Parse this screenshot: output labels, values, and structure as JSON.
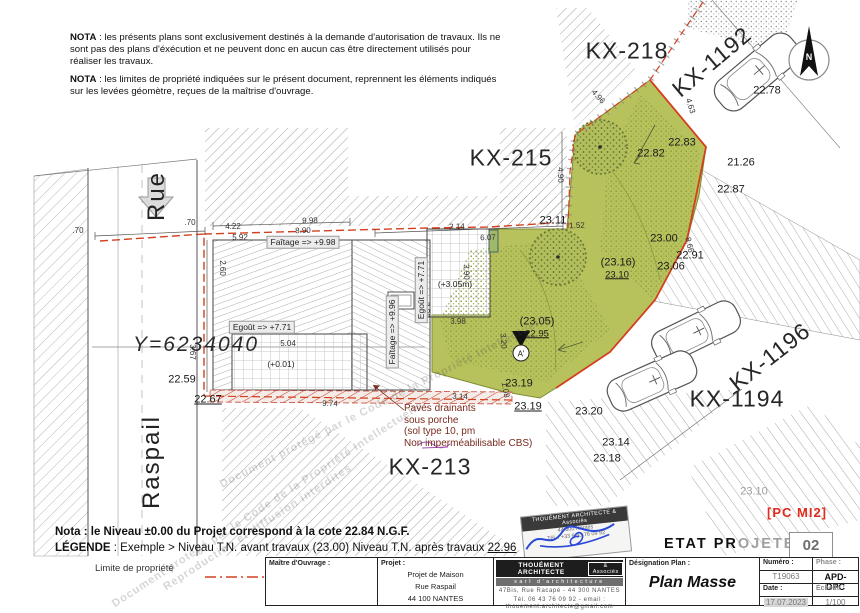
{
  "notes": {
    "nota1_label": "NOTA",
    "nota1_text": " : les présents plans sont exclusivement destinés à la demande d'autorisation de travaux. Ils ne sont pas des plans d'éxécution et ne peuvent donc en aucun cas être directement utilisés pour réaliser les travaux.",
    "nota2_label": "NOTA",
    "nota2_text": " : les limites de propriété indiquées sur le présent document, reprennent les éléments indiqués sur les levées géomètre, reçues de la maîtrise d'ouvrage.",
    "nota_niveau": "Nota : le Niveau ±0.00 du Projet correspond à la cote 22.84 N.G.F.",
    "legende_label": "LÉGENDE",
    "legende_text": " : Exemple > Niveau T.N. avant travaux (23.00)  Niveau T.N. après travaux ",
    "legende_value": "22.96",
    "limite_label": "Limite de propriété"
  },
  "plan": {
    "street_line1": "Rue",
    "street_line2": "Raspail",
    "coordinate_label": "Y=6234040",
    "north_label": "N",
    "section_marker": "A'",
    "parcels": [
      {
        "text": "KX-218",
        "x": 627,
        "y": 51,
        "name": "parcel-label-kx218"
      },
      {
        "text": "KX-215",
        "x": 511,
        "y": 158,
        "name": "parcel-label-kx215"
      },
      {
        "text": "KX-213",
        "x": 430,
        "y": 467,
        "name": "parcel-label-kx213"
      },
      {
        "text": "KX-1192",
        "x": 712,
        "y": 62,
        "rot": -40,
        "name": "parcel-label-kx1192"
      },
      {
        "text": "KX-1196",
        "x": 770,
        "y": 357,
        "rot": -38,
        "name": "parcel-label-kx1196"
      },
      {
        "text": "KX-1194",
        "x": 737,
        "y": 399,
        "name": "parcel-label-kx1194"
      }
    ],
    "levels": [
      {
        "text": "22.78",
        "x": 767,
        "y": 91
      },
      {
        "text": "22.82",
        "x": 651,
        "y": 154
      },
      {
        "text": "22.83",
        "x": 682,
        "y": 143
      },
      {
        "text": "21.26",
        "x": 741,
        "y": 163
      },
      {
        "text": "22.87",
        "x": 731,
        "y": 190
      },
      {
        "text": "23.11",
        "x": 553,
        "y": 221
      },
      {
        "text": "23.00",
        "x": 664,
        "y": 239
      },
      {
        "text": "22.91",
        "x": 690,
        "y": 256
      },
      {
        "text": "23.06",
        "x": 671,
        "y": 267
      },
      {
        "text": "(23.16)",
        "x": 618,
        "y": 263
      },
      {
        "text": "23.10",
        "x": 617,
        "y": 275,
        "cls": "u sm"
      },
      {
        "text": "(23.05)",
        "x": 537,
        "y": 322
      },
      {
        "text": "22.95",
        "x": 537,
        "y": 334,
        "cls": "u sm"
      },
      {
        "text": "23.19",
        "x": 519,
        "y": 384
      },
      {
        "text": "23.19",
        "x": 528,
        "y": 407,
        "cls": "u"
      },
      {
        "text": "23.20",
        "x": 589,
        "y": 412
      },
      {
        "text": "23.14",
        "x": 616,
        "y": 443
      },
      {
        "text": "23.18",
        "x": 607,
        "y": 459
      },
      {
        "text": "23.10",
        "x": 754,
        "y": 492,
        "cls": "gray"
      },
      {
        "text": "22.59",
        "x": 182,
        "y": 380
      },
      {
        "text": "22.67",
        "x": 208,
        "y": 400,
        "cls": "u"
      }
    ],
    "dims": [
      {
        "text": "4.22",
        "x": 233,
        "y": 227
      },
      {
        "text": "5.92",
        "x": 240,
        "y": 238
      },
      {
        "text": ".70",
        "x": 78,
        "y": 231
      },
      {
        "text": ".70",
        "x": 190,
        "y": 223
      },
      {
        "text": "9.98",
        "x": 310,
        "y": 221,
        "rot": -2
      },
      {
        "text": "8.90",
        "x": 303,
        "y": 231,
        "rot": -2
      },
      {
        "text": "3.14",
        "x": 457,
        "y": 227,
        "rot": -2
      },
      {
        "text": "6.07",
        "x": 488,
        "y": 238,
        "rot": -2
      },
      {
        "text": "1.52",
        "x": 577,
        "y": 226,
        "rot": -2
      },
      {
        "text": "4.96",
        "x": 598,
        "y": 97,
        "rot": 48
      },
      {
        "text": "4.63",
        "x": 690,
        "y": 106,
        "rot": 72
      },
      {
        "text": "8.66",
        "x": 689,
        "y": 245,
        "rot": 78
      },
      {
        "text": "4.90",
        "x": 560,
        "y": 175,
        "rot": 88
      },
      {
        "text": "2.60",
        "x": 222,
        "y": 268,
        "rot": 90
      },
      {
        "text": "3.67",
        "x": 192,
        "y": 352,
        "rot": 90
      },
      {
        "text": "5.04",
        "x": 288,
        "y": 344
      },
      {
        "text": "9.74",
        "x": 330,
        "y": 404,
        "rot": 2
      },
      {
        "text": "7.30",
        "x": 426,
        "y": 310,
        "rot": 88
      },
      {
        "text": "3.90",
        "x": 466,
        "y": 272,
        "rot": 88
      },
      {
        "text": "3.98",
        "x": 458,
        "y": 322
      },
      {
        "text": "3.20",
        "x": 503,
        "y": 341,
        "rot": 85
      },
      {
        "text": "3.14",
        "x": 460,
        "y": 397,
        "rot": 3
      },
      {
        "text": "1.08",
        "x": 505,
        "y": 390,
        "rot": 80
      }
    ],
    "building_labels": [
      {
        "text": "Faîtage => +9.98",
        "x": 303,
        "y": 242,
        "cls": "box",
        "name": "roof-ridge-label"
      },
      {
        "text": "Egoût => +7.71",
        "x": 262,
        "y": 327,
        "cls": "box",
        "name": "roof-eave-label"
      },
      {
        "text": "Egoût => +7.71",
        "x": 421,
        "y": 290,
        "rot": -90,
        "cls": "box",
        "name": "roof-eave-label-vertical"
      },
      {
        "text": "Faîtage => +9.96",
        "x": 392,
        "y": 332,
        "rot": -90,
        "cls": "box",
        "name": "roof-ridge-label-vertical"
      },
      {
        "text": "(+3.05m)",
        "x": 455,
        "y": 284,
        "name": "terrace-level-label"
      },
      {
        "text": "(+0.01)",
        "x": 281,
        "y": 364,
        "name": "courtyard-level-label"
      }
    ],
    "watermarks": [
      {
        "text": "Document protégé par le Code de la Propriété Intellectuelle",
        "x": 268,
        "y": 505,
        "rot": -33
      },
      {
        "text": "Reproduction et diffusion interdites",
        "x": 258,
        "y": 528,
        "rot": -33
      },
      {
        "text": "Document protégé par le Code de la Propriété Intellectuelle",
        "x": 385,
        "y": 402,
        "rot": -27
      }
    ],
    "paves_note": [
      "Pavés drainants",
      "sous porche",
      "(sol type 10, pm",
      "Non imperméabilisable CBS)"
    ]
  },
  "titleblock": {
    "maitre_ouvrage_label": "Maître d'Ouvrage :",
    "projet_label": "Projet :",
    "projet_line1": "Projet de Maison",
    "projet_line2": "Rue Raspail",
    "projet_line3": "44 100 NANTES",
    "architect_name": "THOUÉMENT ARCHITECTE",
    "architect_assoc": "& Associés",
    "architect_subtitle": "sarl d'architecture",
    "architect_address": "47Bis, Rue Racapé - 44 300 NANTES",
    "architect_contact": "Tél. 06 43 76 09 92 - email : thouement.architecte@gmail.com",
    "designation_label": "Désignation Plan :",
    "designation_value": "Plan Masse",
    "numero_label": "Numéro :",
    "numero_value": "T19063",
    "date_label": "Date :",
    "date_value": "17.07.2023",
    "phase_label": "Phase :",
    "phase_value": "APD-DPC",
    "echelle_label": "Échelle :",
    "echelle_value": "1/100",
    "etat_part1": "ETAT PR",
    "etat_part2": "OJETE",
    "sheet_number": "02",
    "revision_tag": "[PC MI2]"
  },
  "stamp": {
    "line1": "THOUÉMENT ARCHITECTE & Associés",
    "line2": "44 300 Nantes",
    "line3": "Tél. : +33 6 43 76 09 92"
  },
  "colors": {
    "parcel_green": "#b8c25d",
    "boundary_red": "#d2401f",
    "note_maroon": "#7a2a1e",
    "signature_blue": "#2b49d8",
    "tag_red": "#e02b1d"
  }
}
